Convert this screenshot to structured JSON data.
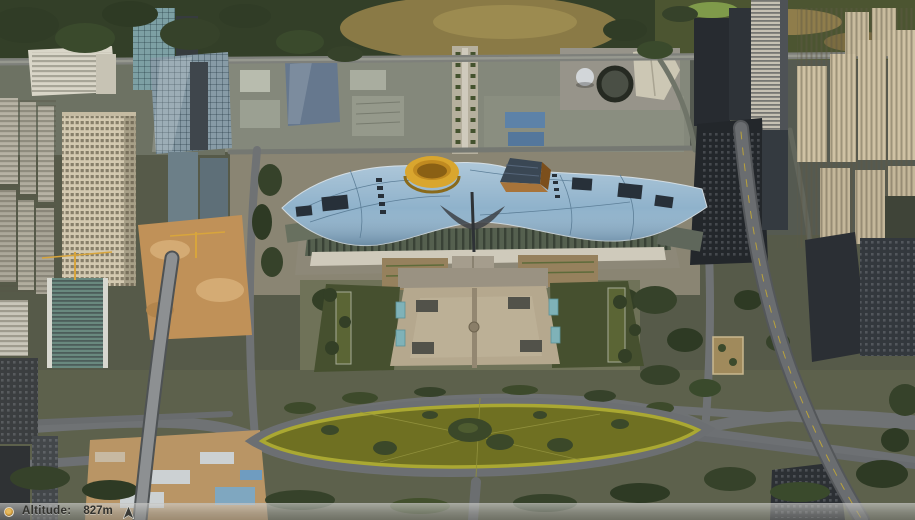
{
  "status_bar": {
    "altitude_label": "Altitude:",
    "altitude_value": "827m"
  },
  "palette": {
    "roof_blue": "#8fb2cb",
    "cylinder_yellow": "#d9a62e",
    "pyramid_orange": "#a8743a",
    "plaza_tan": "#b5a88e",
    "lawn_olive": "#6f7022",
    "lawn_ring_yellow": "#aaa832",
    "forest_green": "#333f28",
    "road_gray": "#6f7274",
    "construction_tan": "#c09158",
    "status_text": "#32322e",
    "streaming_amber": "#c98f2e"
  }
}
